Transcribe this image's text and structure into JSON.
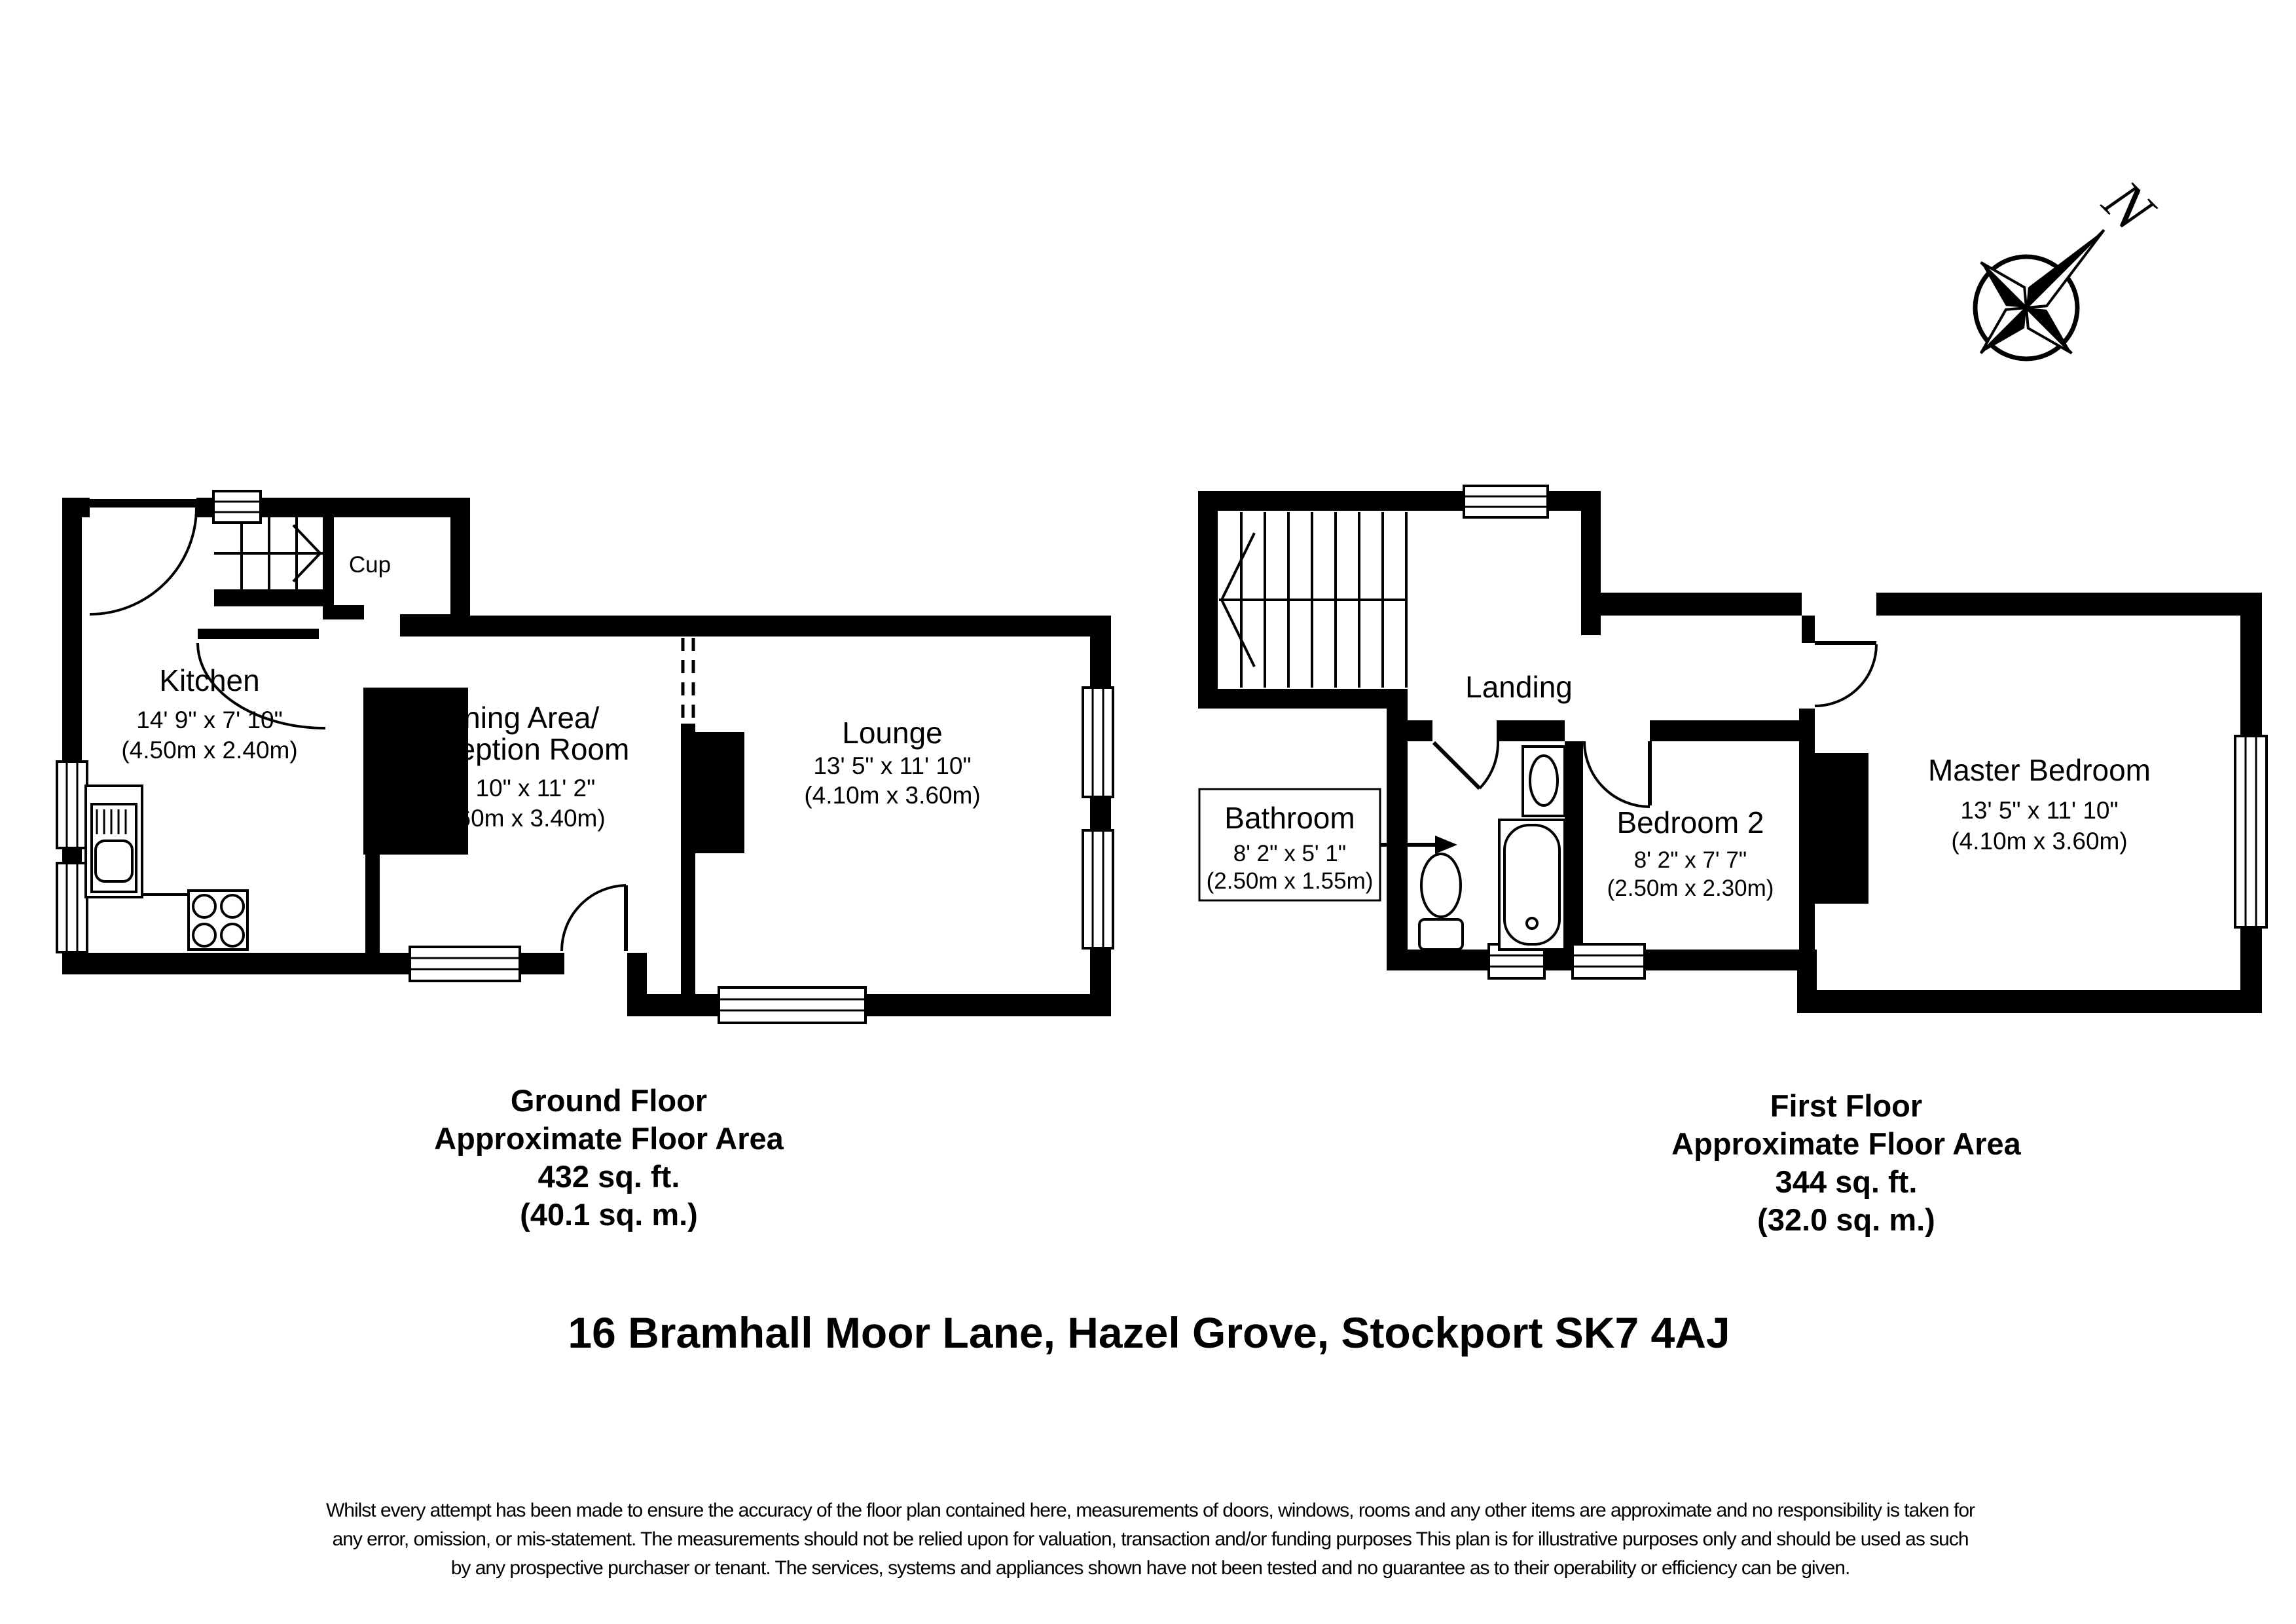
{
  "compass": {
    "north_label": "N"
  },
  "ground_floor": {
    "rooms": {
      "kitchen": {
        "name": "Kitchen",
        "imperial": "14' 9\" x 7' 10\"",
        "metric": "(4.50m x 2.40m)"
      },
      "cupboard": {
        "name": "Cup"
      },
      "dining": {
        "name_line1": "Dining Area/",
        "name_line2": "Reception Room",
        "imperial": "11' 10\" x 11' 2\"",
        "metric": "(3.60m x 3.40m)"
      },
      "lounge": {
        "name": "Lounge",
        "imperial": "13' 5\" x 11' 10\"",
        "metric": "(4.10m x 3.60m)"
      }
    },
    "caption": {
      "line1": "Ground Floor",
      "line2": "Approximate Floor Area",
      "line3": "432 sq. ft.",
      "line4": "(40.1 sq. m.)"
    }
  },
  "first_floor": {
    "rooms": {
      "landing": {
        "name": "Landing"
      },
      "bathroom": {
        "name": "Bathroom",
        "imperial": "8' 2\" x 5' 1\"",
        "metric": "(2.50m x 1.55m)"
      },
      "bedroom2": {
        "name": "Bedroom 2",
        "imperial": "8' 2\" x 7' 7\"",
        "metric": "(2.50m x 2.30m)"
      },
      "master": {
        "name": "Master Bedroom",
        "imperial": "13' 5\" x 11' 10\"",
        "metric": "(4.10m x 3.60m)"
      }
    },
    "caption": {
      "line1": "First Floor",
      "line2": "Approximate Floor Area",
      "line3": "344 sq. ft.",
      "line4": "(32.0 sq. m.)"
    }
  },
  "address": "16 Bramhall Moor Lane, Hazel Grove, Stockport SK7 4AJ",
  "disclaimer": {
    "line1": "Whilst every attempt has been made to ensure the accuracy of the floor plan contained here, measurements of doors, windows, rooms and any other items are approximate and no responsibility is taken for",
    "line2": "any error, omission, or mis-statement. The measurements should not be relied upon for valuation, transaction and/or funding purposes This plan is for illustrative purposes only and should be used as such",
    "line3": "by any prospective purchaser or tenant. The services, systems and appliances shown have not been tested and no guarantee as to their operability or efficiency can be given."
  }
}
